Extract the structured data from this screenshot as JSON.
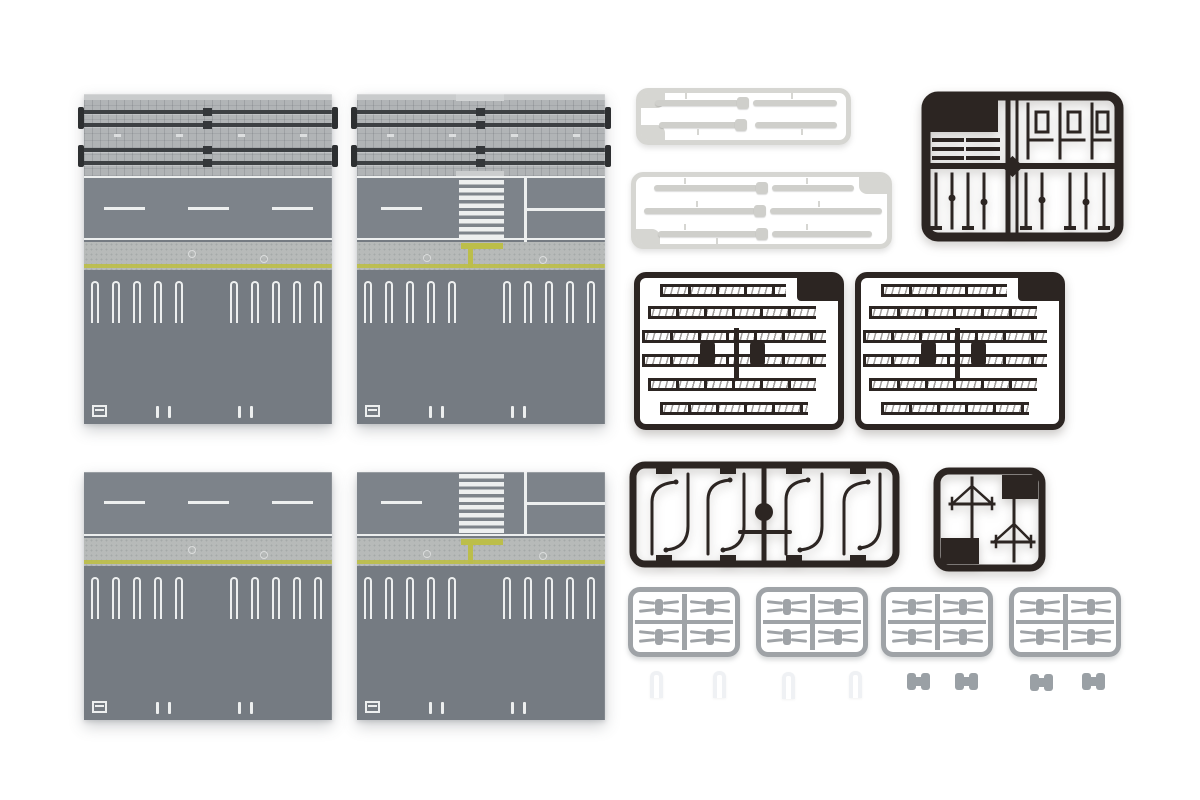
{
  "scene": {
    "type": "product-photo",
    "subject": "Model railway diorama road plate set with plastic part sprues",
    "background_color": "#ffffff"
  },
  "colors": {
    "bg": "#ffffff",
    "road": "#7d838a",
    "parking": "#757b82",
    "sidewalk": "#b7bab9",
    "yellow": "#bcbe4a",
    "trackbed": "#b1b4b6",
    "trackedge": "#c9cbcc",
    "rail": "#3d4043",
    "mark": "#edefef",
    "dark": "#2c2522",
    "white_frame": "#d6d6d2",
    "white_part": "#cfcfcb",
    "gray_frame": "#9fa3a7",
    "small_gray": "#9aa0a5",
    "small_white": "#eff1f4"
  },
  "plates": {
    "count": 4,
    "items": [
      {
        "id": "plate-tracks-straight",
        "position": "top-left",
        "features": [
          "double-track-section",
          "dashed-centerline-road",
          "sidewalk-with-tactile-line",
          "parking-stall-markings"
        ]
      },
      {
        "id": "plate-tracks-crosswalk",
        "position": "top-right",
        "features": [
          "double-track-section",
          "crosswalk",
          "t-intersection-lines",
          "tactile-guide-to-crosswalk",
          "parking-stall-markings"
        ]
      },
      {
        "id": "plate-straight",
        "position": "bottom-left",
        "features": [
          "dashed-centerline-road",
          "sidewalk-with-tactile-line",
          "parking-stall-markings"
        ]
      },
      {
        "id": "plate-crosswalk",
        "position": "bottom-right",
        "features": [
          "crosswalk",
          "t-intersection-lines",
          "tactile-guide-to-crosswalk",
          "parking-stall-markings"
        ]
      }
    ],
    "crosswalk_stripes": 8,
    "parking_stall_groups_per_plate": 2
  },
  "sprues": {
    "white_guardrail_small": {
      "count": 1,
      "bar_rows": 2
    },
    "white_guardrail_large": {
      "count": 1,
      "bar_rows": 3
    },
    "dark_accessory_dense": {
      "count": 1
    },
    "dark_fence_lattice": {
      "count": 2,
      "rows": 6
    },
    "dark_curved_lamp_posts": {
      "count": 1
    },
    "dark_utility_poles": {
      "count": 1
    },
    "gray_clip_sprues": {
      "count": 4
    },
    "loose_white_clips": {
      "count": 4
    },
    "loose_gray_joiners": {
      "count": 4
    }
  },
  "repeat": {
    "stalls_per_group": 5,
    "center_dashes": 3,
    "sleeper_dashes": 4,
    "ticks_per_pair": 2,
    "gray_clip_parts": 4
  }
}
